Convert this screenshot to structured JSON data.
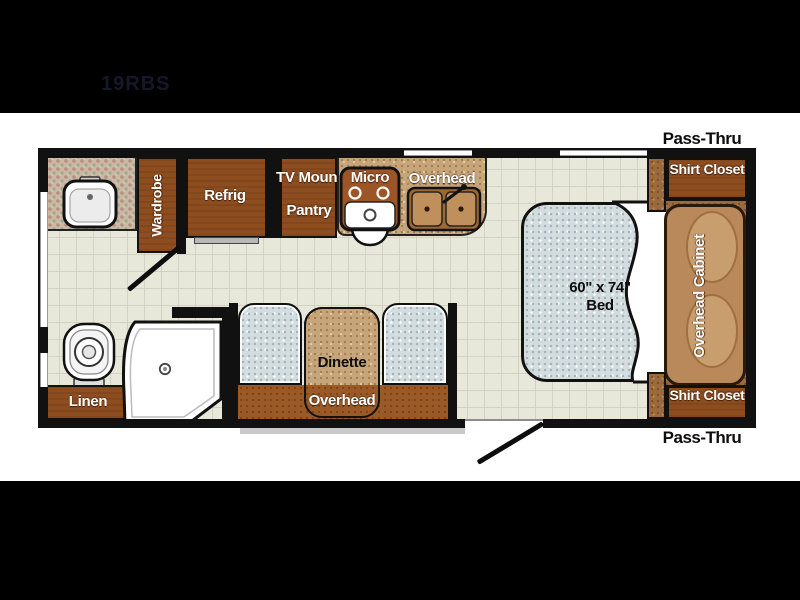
{
  "title": "19RBS",
  "colors": {
    "background": "#000000",
    "paper": "#ffffff",
    "wall": "#111111",
    "cabinet_brown": "#8e4d1f",
    "wood_tan": "#c7a57a",
    "headboard_brown": "#b9895b",
    "floor_tile": "#e7e7da",
    "upholstery_blue": "#d3dcde",
    "label_white": "#ffffff",
    "label_black": "#0d0d0d"
  },
  "plan": {
    "bath": {
      "wardrobe": "Wardrobe",
      "linen": "Linen"
    },
    "kitchen": {
      "refrig": "Refrig",
      "tv_mount": "TV Mount",
      "pantry": "Pantry",
      "micro": "Micro",
      "overhead": "Overhead"
    },
    "dinette": {
      "table": "Dinette",
      "overhead": "Overhead"
    },
    "bedroom": {
      "bed_size": "60\" x 74\"",
      "bed": "Bed",
      "overhead_cabinet": "Overhead Cabinet",
      "shirt_closet_front": "Shirt Closet",
      "shirt_closet_rear": "Shirt Closet",
      "pass_thru_front": "Pass-Thru",
      "pass_thru_rear": "Pass-Thru"
    }
  }
}
